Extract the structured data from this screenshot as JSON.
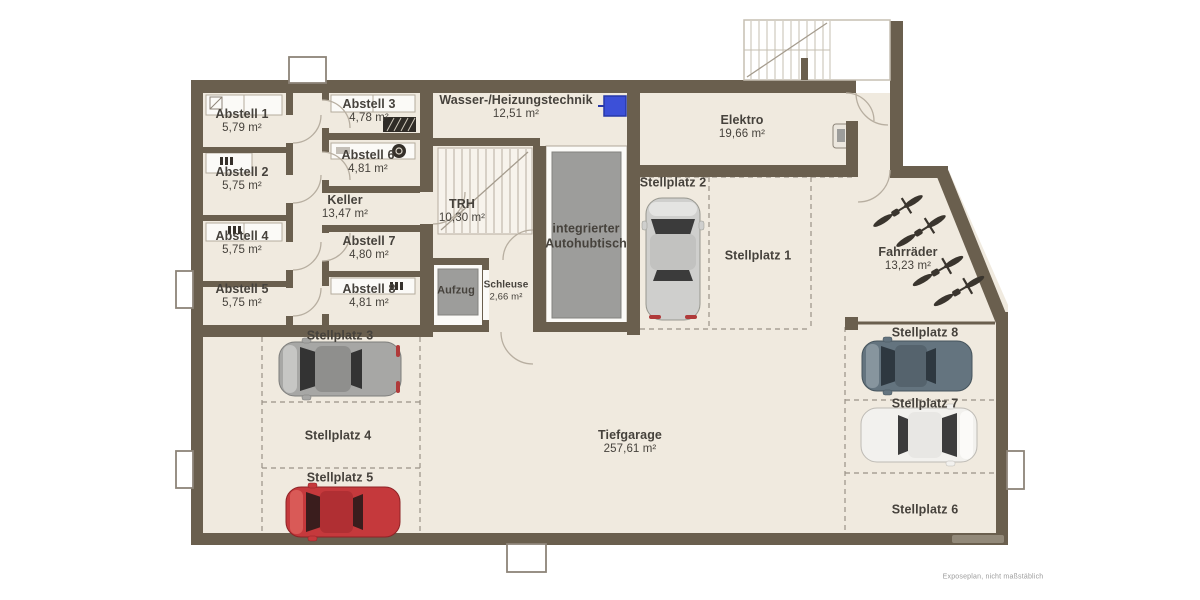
{
  "disclaimer": "Exposeplan, nicht maßstäblich",
  "rooms": {
    "abstell1": {
      "name": "Abstell 1",
      "area": "5,79 m²"
    },
    "abstell2": {
      "name": "Abstell 2",
      "area": "5,75 m²"
    },
    "abstell3": {
      "name": "Abstell 3",
      "area": "4,78 m²"
    },
    "abstell4": {
      "name": "Abstell 4",
      "area": "5,75 m²"
    },
    "abstell5": {
      "name": "Abstell 5",
      "area": "5,75 m²"
    },
    "abstell6": {
      "name": "Abstell 6",
      "area": "4,81 m²"
    },
    "abstell7": {
      "name": "Abstell 7",
      "area": "4,80 m²"
    },
    "abstell8": {
      "name": "Abstell 8",
      "area": "4,81 m²"
    },
    "keller": {
      "name": "Keller",
      "area": "13,47 m²"
    },
    "wasser": {
      "name": "Wasser-/Heizungstechnik",
      "area": "12,51 m²"
    },
    "trh": {
      "name": "TRH",
      "area": "10,30 m²"
    },
    "autohubtisch": {
      "line1": "integrierter",
      "line2": "Autohubtisch"
    },
    "aufzug": {
      "name": "Aufzug"
    },
    "schleuse": {
      "name": "Schleuse",
      "area": "2,66 m²"
    },
    "elektro": {
      "name": "Elektro",
      "area": "19,66 m²"
    },
    "fahrraeder": {
      "name": "Fahrräder",
      "area": "13,23 m²"
    },
    "tiefgarage": {
      "name": "Tiefgarage",
      "area": "257,61 m²"
    }
  },
  "parking": {
    "sp1": {
      "name": "Stellplatz 1",
      "car": "none"
    },
    "sp2": {
      "name": "Stellplatz 2",
      "car": "silver"
    },
    "sp3": {
      "name": "Stellplatz 3",
      "car": "silver-gray"
    },
    "sp4": {
      "name": "Stellplatz 4",
      "car": "none"
    },
    "sp5": {
      "name": "Stellplatz 5",
      "car": "red"
    },
    "sp6": {
      "name": "Stellplatz 6",
      "car": "none"
    },
    "sp7": {
      "name": "Stellplatz 7",
      "car": "white"
    },
    "sp8": {
      "name": "Stellplatz 8",
      "car": "steel-blue"
    }
  },
  "bicycles": {
    "count": 4
  },
  "colors": {
    "wall": "#6a5f4e",
    "floor": "#f0eadf",
    "water_tank": "#3c50d8",
    "car_red": "#c5393c",
    "car_silver": "#cfcfcd",
    "car_steel_blue": "#64747f",
    "car_white": "#f2f1ee"
  }
}
